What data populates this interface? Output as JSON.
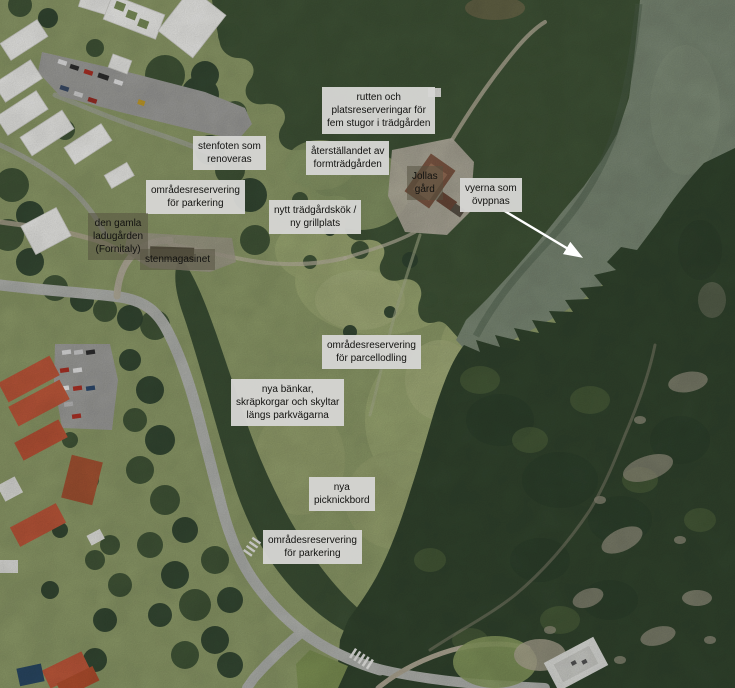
{
  "map": {
    "kind": "annotated aerial photograph",
    "palette": {
      "meadow": "#909e6b",
      "forest": "#3f5437",
      "forest_dark": "#33462f",
      "water": "#7d8b77",
      "road": "#b6b8b3",
      "parking_asphalt": "#a2a29f",
      "building_white": "#f2f2ef",
      "roof_red": "#c25a3c",
      "label_light_bg": "#d5d5d3",
      "label_dark_bg": "rgba(84,80,64,0.52)",
      "label_text": "#121210",
      "arrow": "#ffffff"
    },
    "arrow": {
      "name": "view-direction-arrow",
      "color": "#ffffff",
      "direction": "southeast",
      "from_label": "vyerna som öppnas"
    }
  },
  "labels": [
    {
      "id": "cottages-route",
      "variant": "light",
      "text": "rutten och\nplatsreserveringar för\nfem stugor i trädgården"
    },
    {
      "id": "stone-foundation",
      "variant": "light",
      "text": "stenfoten som\nrenoveras"
    },
    {
      "id": "formal-garden",
      "variant": "light",
      "text": "återställandet av\nformträdgården"
    },
    {
      "id": "jollas-gard",
      "variant": "dark",
      "text": "Jollas\ngård"
    },
    {
      "id": "views-opening",
      "variant": "light",
      "text": "vyerna som\növppnas"
    },
    {
      "id": "parking-reservation-north",
      "variant": "light",
      "text": "områdesreservering\nför parkering"
    },
    {
      "id": "garden-kitchen",
      "variant": "light",
      "text": "nytt trädgårdskök /\nny grillplats"
    },
    {
      "id": "old-barn",
      "variant": "dark",
      "text": "den gamla\nladugården\n(Fornitaly)"
    },
    {
      "id": "stone-magazine",
      "variant": "dark",
      "text": "stenmagasinet"
    },
    {
      "id": "allotment-reservation",
      "variant": "light",
      "text": "områdesreservering\nför parcellodling"
    },
    {
      "id": "benches-and-signs",
      "variant": "light",
      "text": "nya bänkar,\nskräpkorgar och skyltar\nlängs parkvägarna"
    },
    {
      "id": "picnic-tables",
      "variant": "light",
      "text": "nya\npicknickbord"
    },
    {
      "id": "parking-reservation-south",
      "variant": "light",
      "text": "områdesreservering\nför parkering"
    }
  ]
}
